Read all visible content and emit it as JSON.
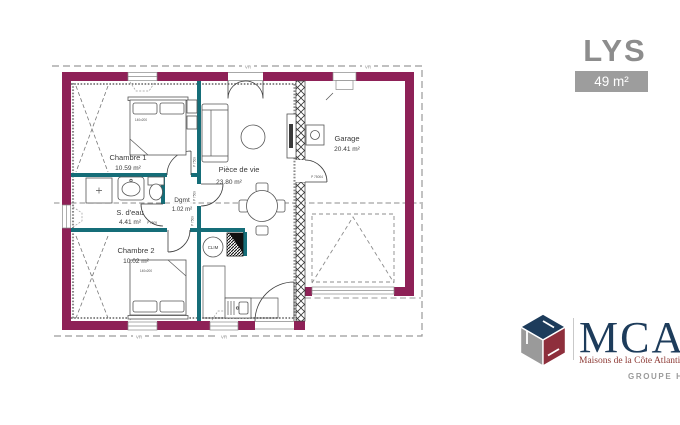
{
  "header": {
    "title": "LYS",
    "area_badge": "49 m²"
  },
  "plan": {
    "rooms": {
      "chambre1": {
        "name": "Chambre 1",
        "area": "10.59 m²"
      },
      "sdeau": {
        "name": "S. d'eau",
        "area": "4.41 m²"
      },
      "dgmt": {
        "name": "Dgmt",
        "area": "1.02 m²"
      },
      "chambre2": {
        "name": "Chambre 2",
        "area": "10.02 m²"
      },
      "piece_de_vie": {
        "name": "Pièce de vie",
        "area": "23.80 m²"
      },
      "garage": {
        "name": "Garage",
        "area": "20.41 m²"
      }
    },
    "labels": {
      "clim": "CLIM",
      "bed1_size": "140x200",
      "bed2_size": "140x200",
      "vr1": "VR",
      "vr2": "VR",
      "vr3": "VR",
      "vr4": "VR",
      "door_ref_ch1": "P 7509",
      "door_ref_dgmt": "P 7509",
      "door_ref_bath": "P 7509",
      "door_ref_ch2": "P 7509",
      "door_ref_garage": "P 75004"
    },
    "colors": {
      "wall": "#8e2157",
      "partition": "#156d78",
      "roof_dash": "#9a9a9a"
    }
  },
  "brand": {
    "name": "MCA",
    "tagline": "Maisons de la Côte Atlantique",
    "group": "GROUPE HEXAÔM",
    "colors": {
      "blue": "#1d3c5b",
      "red": "#8e2f3c",
      "gray": "#9a9a9a"
    }
  }
}
